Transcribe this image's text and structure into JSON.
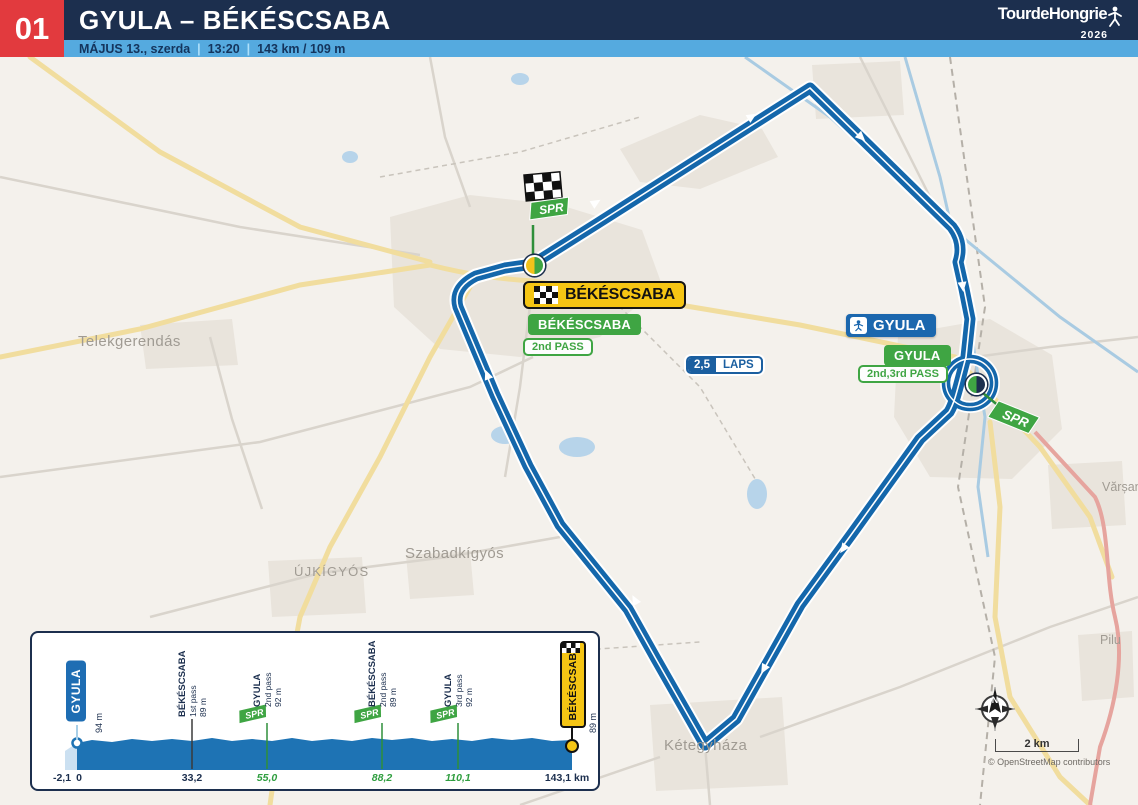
{
  "header": {
    "stage_number": "01",
    "title": "GYULA – BÉKÉSCSABA",
    "date": "MÁJUS 13., szerda",
    "sep": "|",
    "time": "13:20",
    "distance": "143 km / 109 m",
    "logo": {
      "name": "TourdeHongrie",
      "year": "2026"
    }
  },
  "map": {
    "bekescsaba": {
      "finish_sign": "BÉKÉSCSABA",
      "pass_sign": "BÉKÉSCSABA",
      "pass_note": "2nd PASS"
    },
    "gyula": {
      "main_sign": "GYULA",
      "pass_sign": "GYULA",
      "pass_note": "2nd,3rd PASS"
    },
    "laps_badge": {
      "value": "2,5",
      "label": "LAPS"
    },
    "sprint_label": "SPR",
    "towns": [
      "Telekgerendás",
      "Szabadkígyós",
      "ÚJKÍGYÓS",
      "Kétegyháza",
      "Vărșand",
      "Pilu"
    ],
    "compass_label": "N",
    "scale_label": "2 km",
    "attribution": "© OpenStreetMap contributors"
  },
  "profile": {
    "start": {
      "name": "GYULA",
      "elev": "94 m"
    },
    "axis": {
      "neutral": "-2,1",
      "zero": "0"
    },
    "markers": [
      {
        "name": "BÉKÉSCSABA",
        "pass": "1st pass",
        "elev": "89 m",
        "km": "33,2"
      },
      {
        "name": "GYULA",
        "pass": "2nd pass",
        "elev": "92 m",
        "km": "55,0"
      },
      {
        "name": "BÉKÉSCSABA",
        "pass": "2nd pass",
        "elev": "89 m",
        "km": "88,2"
      },
      {
        "name": "GYULA",
        "pass": "3rd pass",
        "elev": "92 m",
        "km": "110,1"
      }
    ],
    "finish": {
      "name": "BÉKÉSCSABA",
      "elev": "89 m",
      "km": "143,1 km"
    }
  }
}
